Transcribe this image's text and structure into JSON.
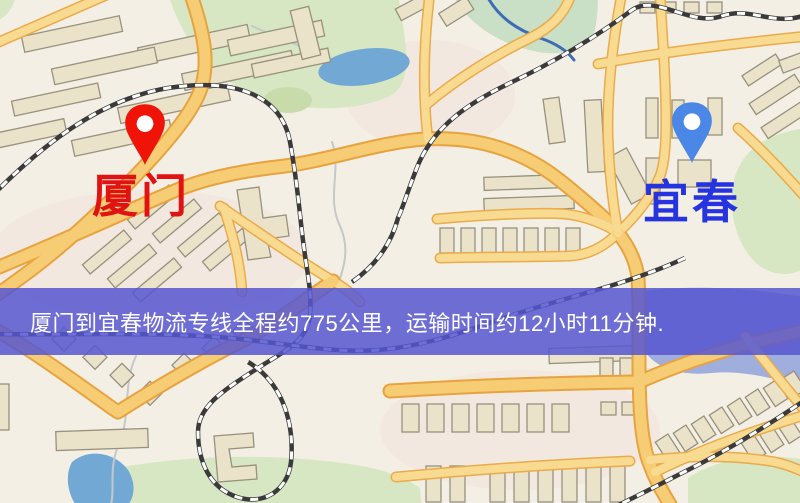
{
  "banner": {
    "text": "厦门到宜春物流专线全程约775公里，运输时间约12小时11分钟.",
    "background_color": "rgba(86,86,209,0.85)",
    "text_color": "#ffffff"
  },
  "route": {
    "origin": "厦门",
    "destination": "宜春",
    "distance_km": 775,
    "distance_text": "全程约775公里",
    "duration_text": "运输时间约12小时11分钟"
  },
  "markers": {
    "origin": {
      "label": "厦门",
      "pin_color": "#f01408",
      "label_color": "#e01212"
    },
    "destination": {
      "label": "宜春",
      "pin_color": "#4a87e6",
      "label_color": "#2634df"
    }
  },
  "map_colors": {
    "background": "#f4efe5",
    "road_fill": "#f8da90",
    "road_casing": "#e9ab4c",
    "building_fill": "#eae2c9",
    "park_green": "#d7e7c3",
    "pond_blue": "#72a9d4",
    "lake_blue": "#9faedc",
    "railway_dark": "#3a3a3a"
  }
}
